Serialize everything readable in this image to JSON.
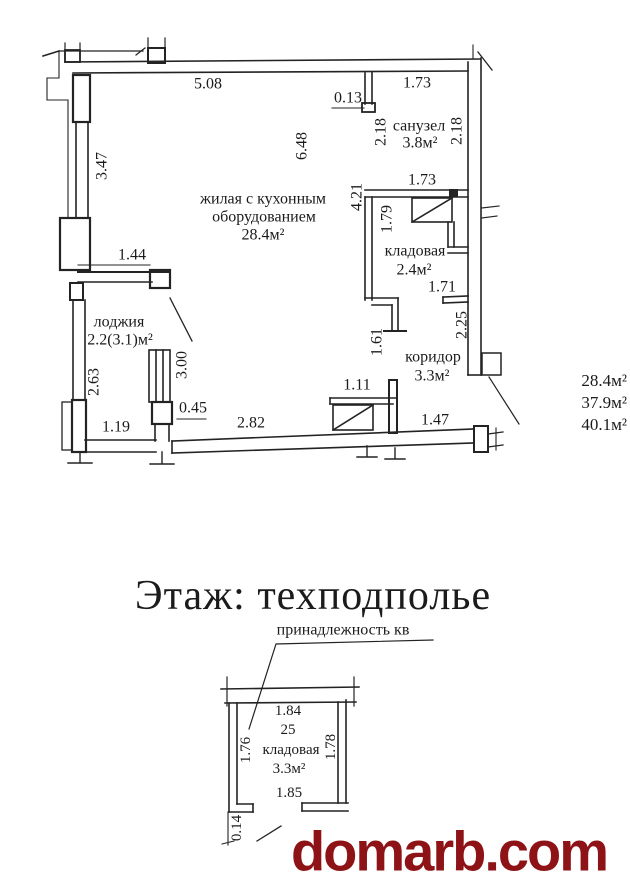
{
  "main_plan": {
    "rooms": {
      "living": {
        "name_line1": "жилая с кухонным",
        "name_line2": "оборудованием",
        "area": "28.4м²"
      },
      "bathroom": {
        "name": "санузел",
        "area": "3.8м²"
      },
      "storage": {
        "name": "кладовая",
        "area": "2.4м²"
      },
      "corridor": {
        "name": "коридор",
        "area": "3.3м²"
      },
      "loggia": {
        "name": "лоджия",
        "area": "2.2(3.1)м²"
      }
    },
    "dimensions": {
      "top_width": "5.08",
      "niche": "0.13",
      "bath_width_top": "1.73",
      "bath_width_bottom": "1.73",
      "living_height": "6.48",
      "left_height": "3.47",
      "bath_height_left": "2.18",
      "bath_height_right": "2.18",
      "inner_height": "4.21",
      "storage_height": "1.79",
      "storage_width": "1.71",
      "corridor_height": "2.25",
      "loggia_top": "1.44",
      "loggia_height": "2.63",
      "window": "3.00",
      "storage_wall": "1.61",
      "pier": "0.45",
      "loggia_bottom": "1.19",
      "bottom_left": "2.82",
      "door": "1.11",
      "bottom_right": "1.47"
    },
    "area_summary": [
      "28.4м²",
      "37.9м²",
      "40.1м²"
    ]
  },
  "basement": {
    "title": "Этаж: техподполье",
    "note": "принадлежность кв",
    "unit_number": "25",
    "room": {
      "name": "кладовая",
      "area": "3.3м²"
    },
    "dimensions": {
      "top": "1.84",
      "left": "1.76",
      "right": "1.78",
      "bottom": "1.85",
      "wall": "0.14"
    }
  },
  "watermark": {
    "text": "domarb.com",
    "color": "#8e1316"
  }
}
